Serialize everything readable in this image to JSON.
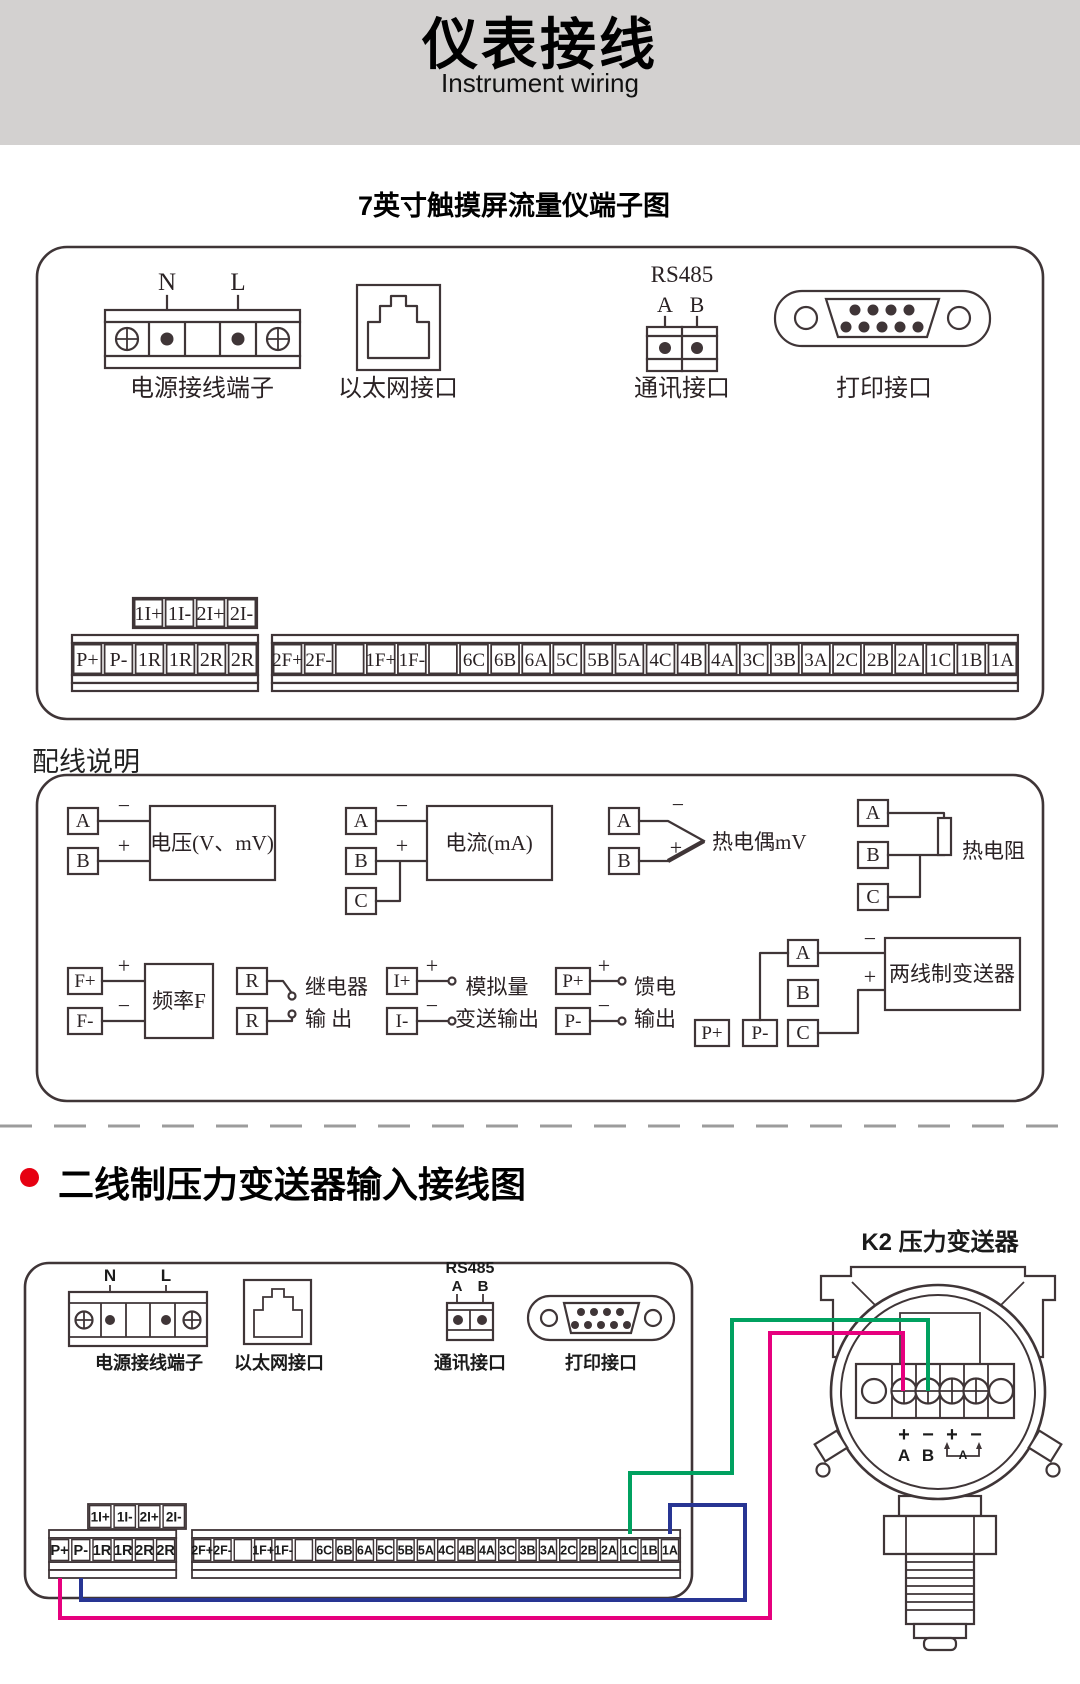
{
  "banner": {
    "title": "仪表接线",
    "subtitle": "Instrument wiring",
    "bg": "#d3d1d0"
  },
  "section1_heading": "7英寸触摸屏流量仪端子图",
  "instrument": {
    "power": {
      "label": "电源接线端子",
      "pin1": "N",
      "pin2": "L"
    },
    "ethernet": {
      "label": "以太网接口"
    },
    "comm": {
      "label": "通讯接口",
      "bus": "RS485",
      "pin1": "A",
      "pin2": "B"
    },
    "print": {
      "label": "打印接口"
    },
    "strips": {
      "aux": [
        "1I+",
        "1I-",
        "2I+",
        "2I-"
      ],
      "main_left": [
        "P+",
        "P-",
        "1R",
        "1R",
        "2R",
        "2R"
      ],
      "main_right": [
        "2F+",
        "2F-",
        "",
        "1F+",
        "1F-",
        "",
        "6C",
        "6B",
        "6A",
        "5C",
        "5B",
        "5A",
        "4C",
        "4B",
        "4A",
        "3C",
        "3B",
        "3A",
        "2C",
        "2B",
        "2A",
        "1C",
        "1B",
        "1A"
      ]
    }
  },
  "wiring_notes": {
    "heading": "配线说明",
    "d_voltage": {
      "t1": "A",
      "t2": "B",
      "s1": "−",
      "s2": "+",
      "label": "电压(V、mV)"
    },
    "d_current": {
      "t1": "A",
      "t2": "B",
      "t3": "C",
      "s1": "−",
      "s2": "+",
      "label": "电流(mA)"
    },
    "d_tc": {
      "t1": "A",
      "t2": "B",
      "s1": "−",
      "s2": "+",
      "label": "热电偶mV"
    },
    "d_rtd": {
      "t1": "A",
      "t2": "B",
      "t3": "C",
      "label": "热电阻"
    },
    "d_freq": {
      "t1": "F+",
      "t2": "F-",
      "s1": "+",
      "s2": "−",
      "label": "频率F"
    },
    "d_relay": {
      "t1": "R",
      "t2": "R",
      "label1": "继电器",
      "label2": "输 出"
    },
    "d_analog": {
      "t1": "I+",
      "t2": "I-",
      "s1": "+",
      "s2": "−",
      "label1": "模拟量",
      "label2": "变送输出"
    },
    "d_feed": {
      "t1": "P+",
      "t2": "P-",
      "s1": "+",
      "s2": "−",
      "label1": "馈电",
      "label2": "输出"
    },
    "d_2wire": {
      "t1": "A",
      "t2": "B",
      "t3": "C",
      "t4": "P+",
      "t5": "P-",
      "s1": "−",
      "s2": "+",
      "label": "两线制变送器"
    }
  },
  "section2": {
    "heading": "二线制压力变送器输入接线图",
    "transmitter": {
      "title": "K2 压力变送器",
      "sign1": "+",
      "sign2": "−",
      "sign3": "+",
      "sign4": "−",
      "term1": "A",
      "term2": "B",
      "meter": "A"
    }
  },
  "colors": {
    "ink": "#3F3537",
    "banner_bg": "#d3d1d0",
    "bullet_red": "#E60012",
    "wire_green": "#00A160",
    "wire_pink": "#E6007E",
    "wire_blue": "#283593"
  }
}
